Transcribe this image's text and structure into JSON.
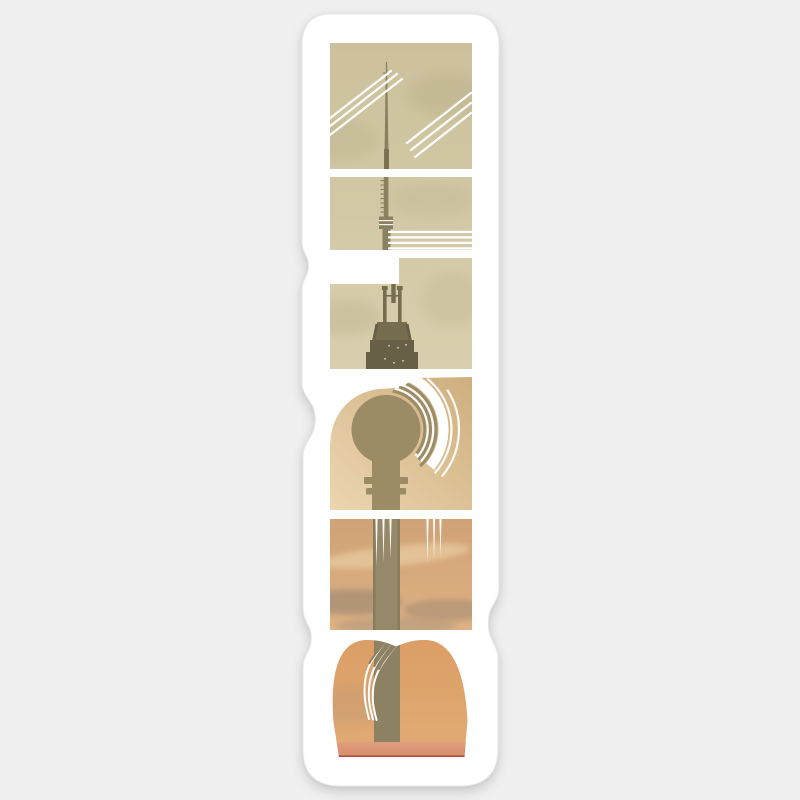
{
  "product": {
    "kind": "die-cut vinyl sticker mockup",
    "word": "BERLIN",
    "reading": "letters rotated 90 degrees counter-clockwise, read bottom to top",
    "subject": "Berlin TV Tower (Fernsehturm) silhouette against a sunset sky",
    "alt": "BERLIN vertical sticker with the Berlin TV Tower photo masked inside the letterforms"
  },
  "letters": [
    {
      "letter": "N",
      "position": 1,
      "depicts": "antenna tip in khaki sky with two groups of diagonal contrail streaks"
    },
    {
      "letter": "I",
      "position": 2,
      "depicts": "antenna mast with four horizontal streak lines"
    },
    {
      "letter": "L",
      "position": 3,
      "depicts": "antenna platforms and lattice of the tower"
    },
    {
      "letter": "R",
      "position": 4,
      "depicts": "tower sphere with concentric echo arcs in golden sky"
    },
    {
      "letter": "E",
      "position": 5,
      "depicts": "tower shaft in amber clouds with tapered drip streaks"
    },
    {
      "letter": "B",
      "position": 6,
      "depicts": "tower base dome above a salmon sunset horizon band"
    }
  ],
  "colors": {
    "bg": "#f0f0f1",
    "stickerWhite": "#ffffff",
    "stickerEdge": "#e9e9e9",
    "skyKhakiTop": "#ccc19c",
    "skyKhakiBottom": "#d9cfae",
    "cloudKhaki": "#b3a884",
    "skyGoldDark": "#d0b080",
    "skyGoldLight": "#ecd6b0",
    "skyAmberTop": "#cfa377",
    "skyAmberBottom": "#dfb183",
    "cloudDark": "#8a7d6f",
    "cloudWarm": "#a6927c",
    "streakLight": "#f0d8ab",
    "skyPeachTop": "#db9e65",
    "skyPeachBottom": "#e2ab76",
    "salmonTop": "#df9e7e",
    "salmonBottom": "#d78c6b",
    "horizonRed": "#a85138",
    "mastOlive": "#8a8161",
    "towerMid": "#766d4e",
    "towerDark": "#686046",
    "sphereOlive": "#9c8c66",
    "shaftOlive": "#95896a",
    "shaftPeach": "#8d8163",
    "lineWhite": "#ffffff"
  }
}
